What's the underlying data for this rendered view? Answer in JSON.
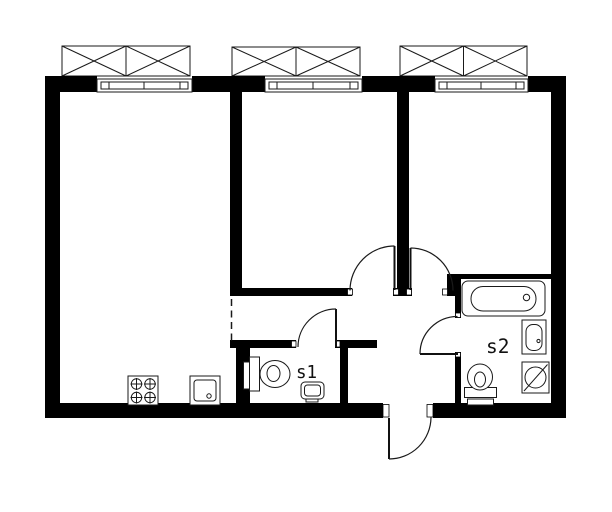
{
  "plan": {
    "background_color": "#ffffff",
    "wall_color": "#000000",
    "line_color": "#1a1a1a",
    "room_labels": {
      "s1": "s1",
      "s2": "s2"
    },
    "window_count": 3,
    "door_count": 5,
    "fixture_icons": {
      "kitchen": [
        "stove-icon",
        "kitchen-sink-icon"
      ],
      "s1_bathroom": [
        "toilet-icon",
        "washbasin-icon",
        "towel-rail-icon"
      ],
      "s2_bathroom": [
        "bathtub-icon",
        "washbasin-icon",
        "toilet-icon",
        "washing-machine-icon"
      ]
    }
  }
}
